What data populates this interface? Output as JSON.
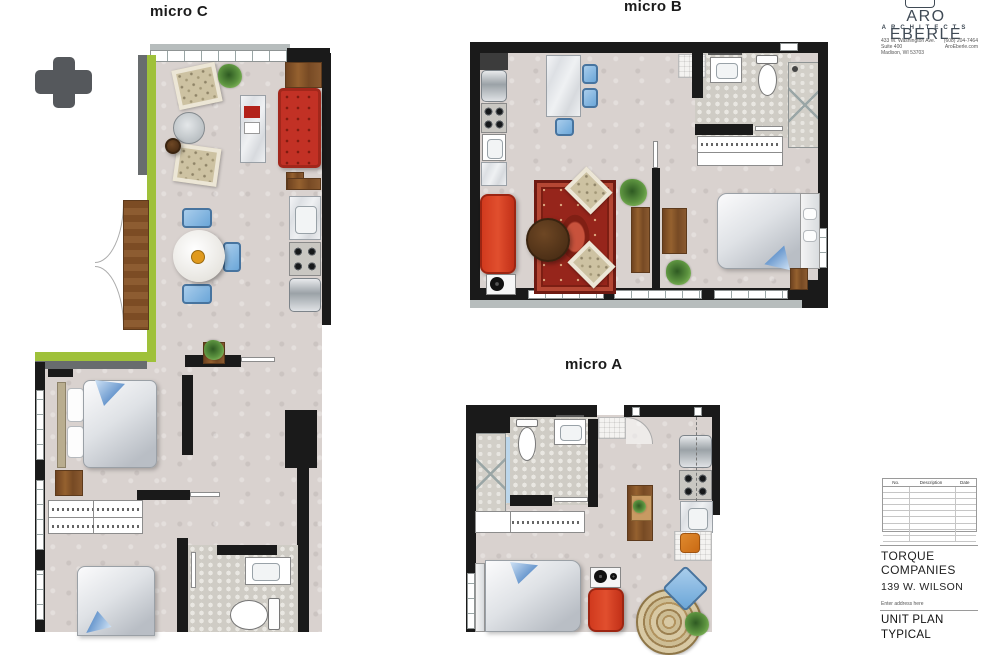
{
  "plans": {
    "micro_c": {
      "label": "micro C"
    },
    "micro_b": {
      "label": "micro B"
    },
    "micro_a": {
      "label": "micro A"
    }
  },
  "titleblock": {
    "logo_name": "ARO EBERLE",
    "logo_subtitle": "ARCHITECTS",
    "address": {
      "line1": "433 W. Washington Ave.",
      "line2": "Suite 400",
      "line3": "Madison, WI 53703"
    },
    "contact": {
      "phone": "(608) 204-7464",
      "website": "AroEberle.com"
    },
    "revisions": {
      "col_no": "No.",
      "col_description": "Description",
      "col_date": "Date"
    },
    "client": "TORQUE COMPANIES",
    "project": "139 W. WILSON",
    "address_placeholder": "Enter address here",
    "sheet_title": "UNIT PLAN",
    "sheet_title_line2": "TYPICAL"
  },
  "colors": {
    "wall": "#1a1a1a",
    "floor": "#d9d2cf",
    "tile": "#e9e7e2",
    "accent-green": "#9fc13a",
    "sofa-red": "#d13a1e",
    "rug-red": "#96251b",
    "brand": "#3f4a55"
  }
}
